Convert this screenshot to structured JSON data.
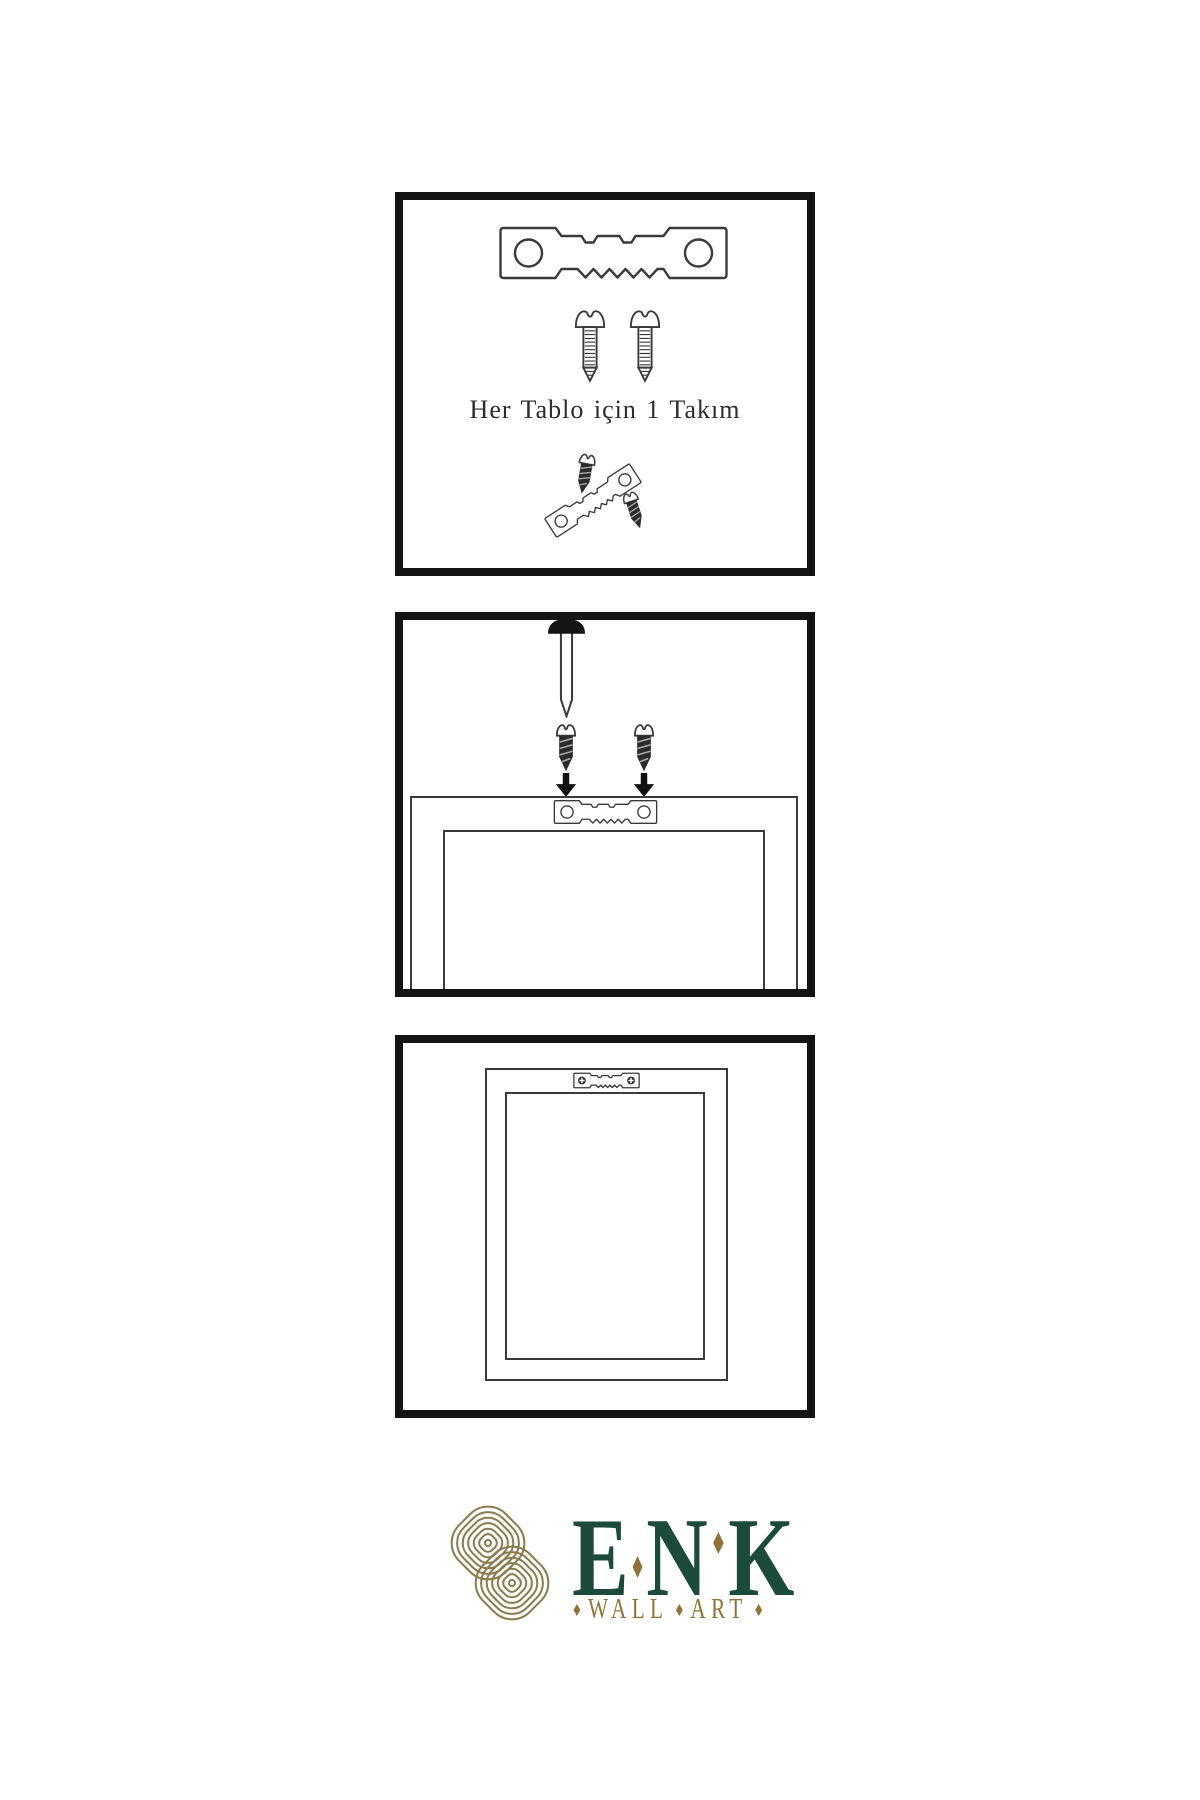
{
  "colors": {
    "panel_border": "#141414",
    "line_art": "#3a3a3a",
    "dark_fill": "#2b2b2b",
    "brand_green": "#1d4b3b",
    "brand_gold": "#8e7339",
    "icon_gold": "#8b7a4b"
  },
  "steps": {
    "parts": {
      "caption": "Her Tablo için 1 Takım"
    }
  },
  "brand": {
    "letters": [
      "E",
      "N",
      "K"
    ],
    "tagline_words": [
      "WALL",
      "ART"
    ]
  },
  "icons": {
    "sawtooth_hanger": "sawtooth-hanger",
    "screw": "screw",
    "dark_screw": "dark-screw",
    "nail": "nail",
    "arrow_down": "arrow-down",
    "knot": "interlaced-knot",
    "diamond": "diamond"
  }
}
